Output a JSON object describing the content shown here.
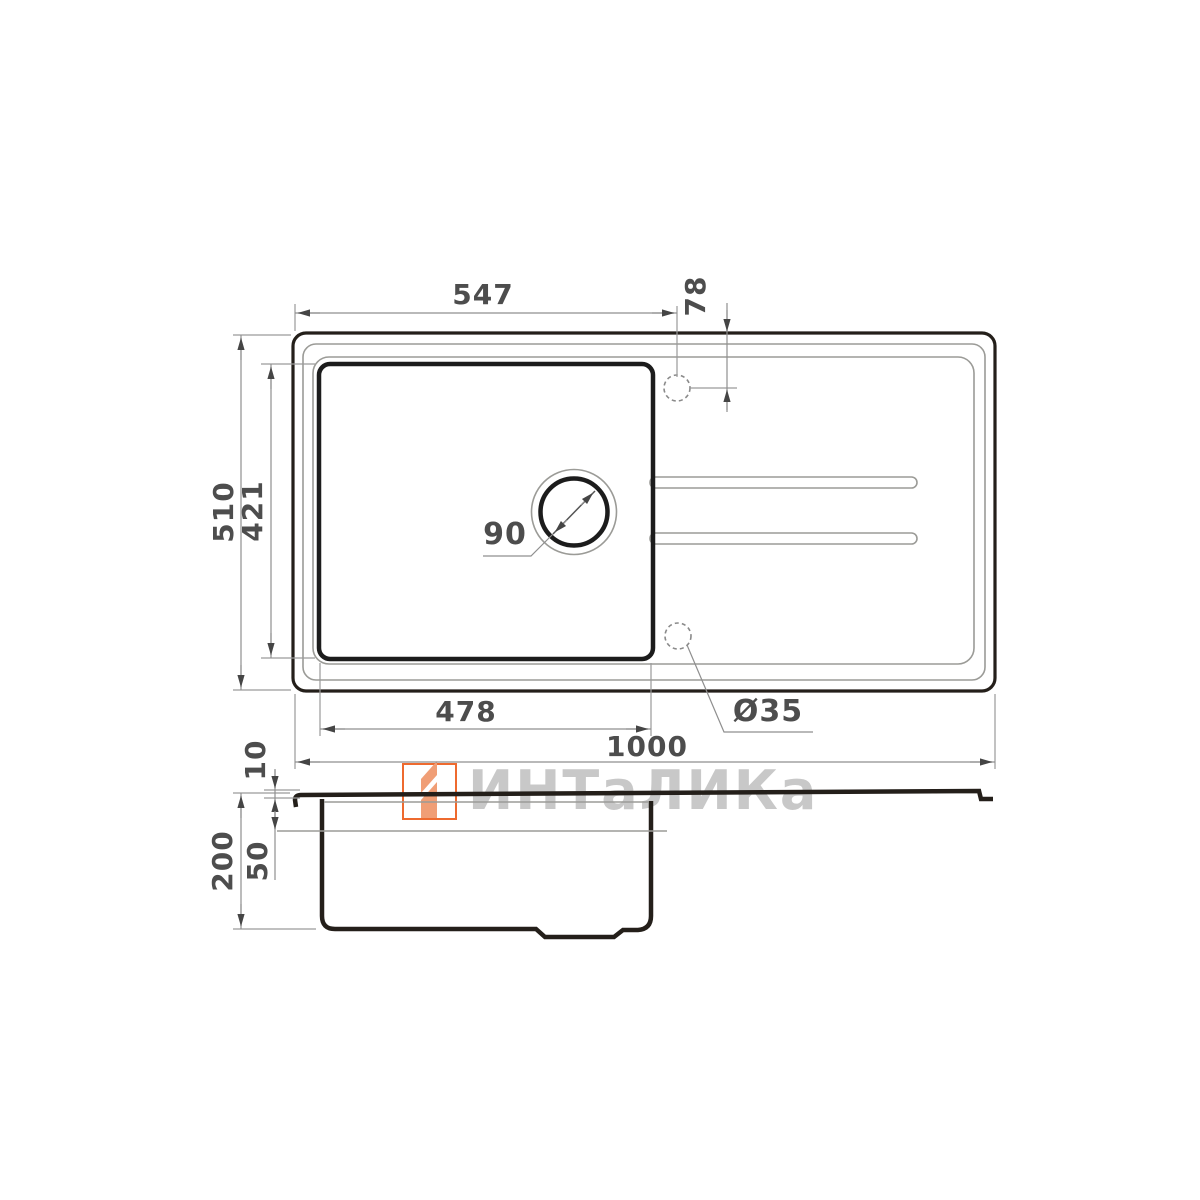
{
  "dimensions": {
    "tap_from_left": "547",
    "tap_from_top": "78",
    "overall_width": "510",
    "bowl_inner_width": "421",
    "drain_diameter": "90",
    "bowl_length": "478",
    "tap_hole_diameter": "Ø35",
    "overall_length": "1000",
    "rim_height": "10",
    "total_depth": "200",
    "upper_depth": "50"
  },
  "watermark": {
    "text": "ИНТаЛИКа"
  },
  "colors": {
    "line_dark": "#241f1a",
    "line_thin": "#9b9b97",
    "dim_line": "#8f8f8f",
    "arrow": "#454545",
    "dim_text": "#4d4d4d",
    "watermark_text": "#c8c8c8",
    "logo_outline": "#ee6a2f",
    "logo_fill": "#f09e76"
  }
}
